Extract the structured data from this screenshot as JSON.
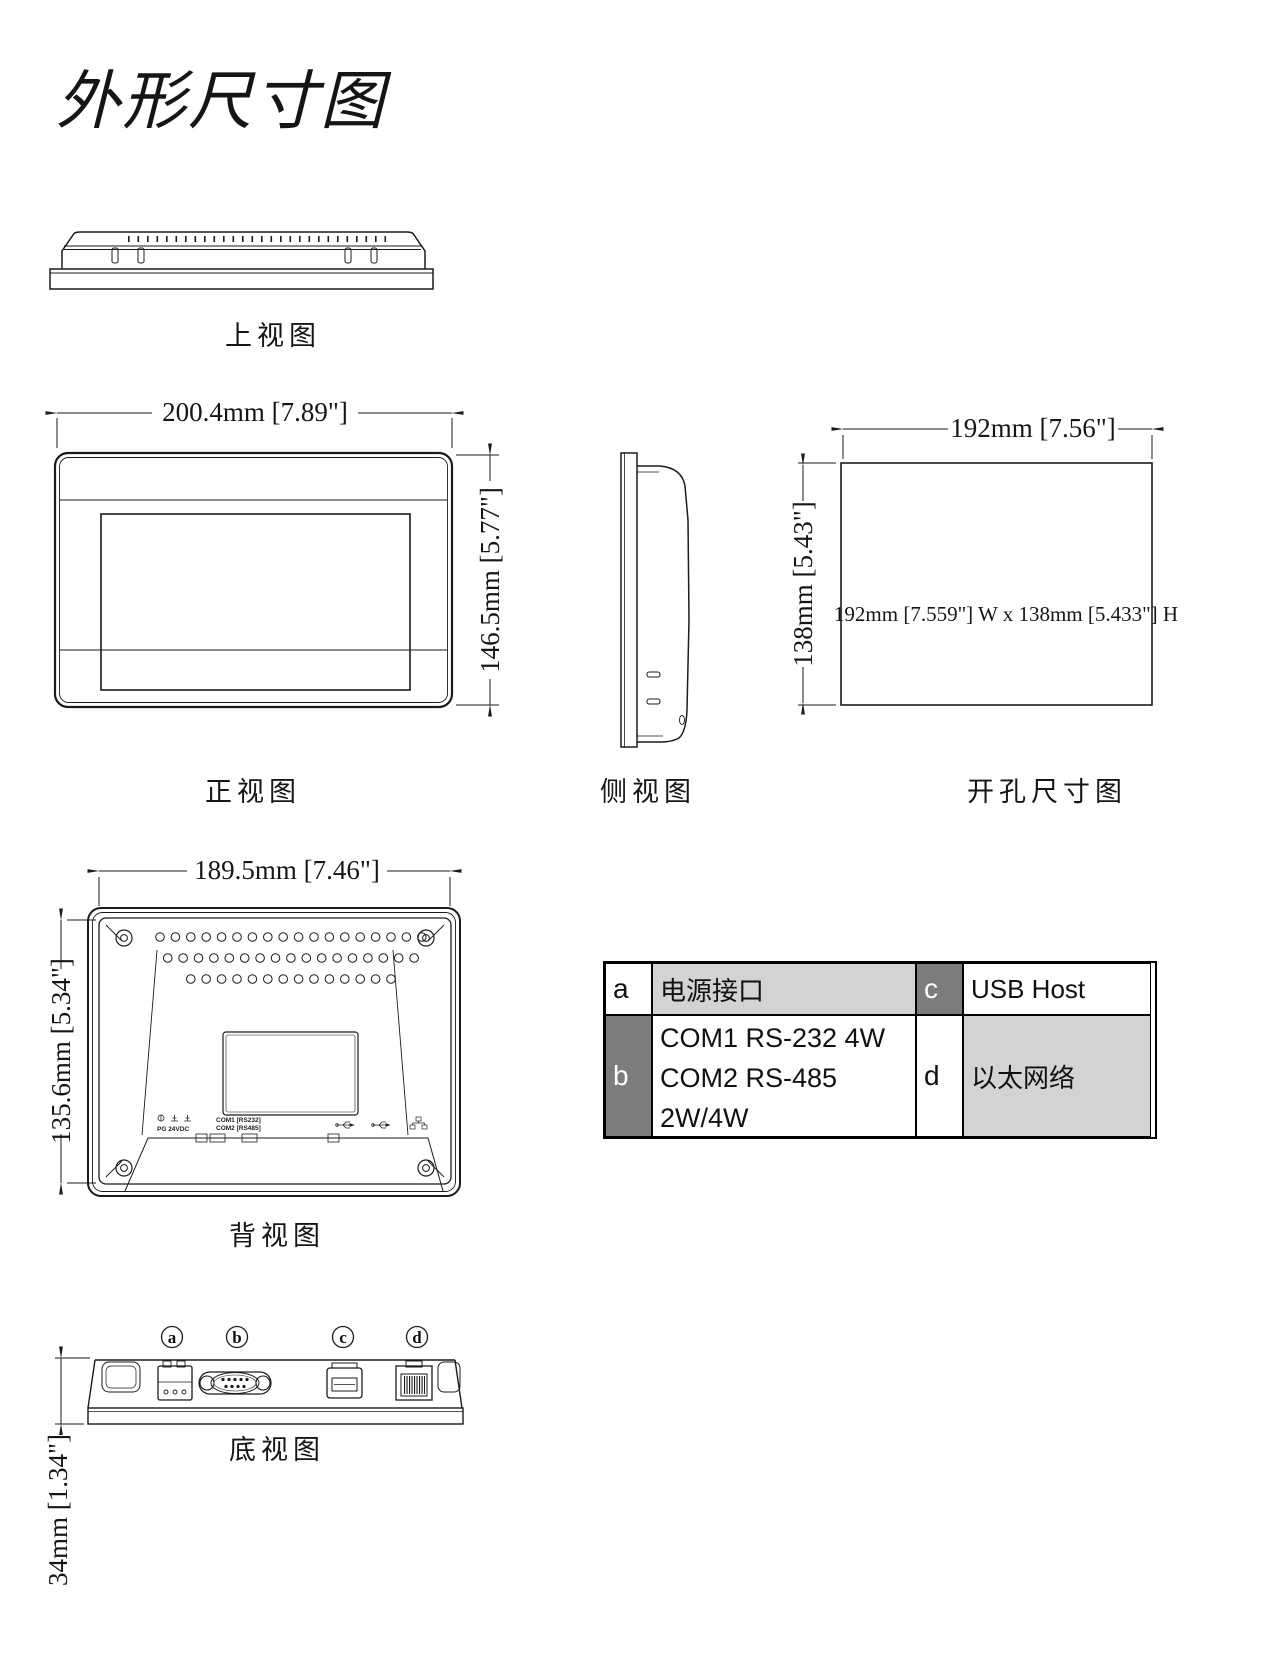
{
  "page": {
    "title": "外形尺寸图",
    "background": "#ffffff",
    "line_color": "#1b1b1b"
  },
  "views": {
    "top": {
      "label": "上视图"
    },
    "front": {
      "label": "正视图",
      "width_dim": "200.4mm [7.89\"]",
      "height_dim": "146.5mm [5.77\"]"
    },
    "side": {
      "label": "侧视图"
    },
    "cutout": {
      "label": "开孔尺寸图",
      "width_dim": "192mm [7.56\"]",
      "height_dim": "138mm [5.43\"]",
      "note": "192mm [7.559\"] W x 138mm [5.433\"] H"
    },
    "back": {
      "label": "背视图",
      "width_dim": "189.5mm [7.46\"]",
      "height_dim": "135.6mm [5.34\"]",
      "markings": {
        "power": "PG  24VDC",
        "com1": "COM1 [RS232]",
        "com2": "COM2 [RS485]"
      }
    },
    "bottom": {
      "label": "底视图",
      "depth_dim": "34mm [1.34\"]",
      "callouts": [
        "a",
        "b",
        "c",
        "d"
      ]
    }
  },
  "legend_table": {
    "a_key": "a",
    "a_value": "电源接口",
    "b_key": "b",
    "b_value_line1": "COM1 RS-232 4W",
    "b_value_line2": "COM2 RS-485",
    "b_value_line3": "2W/4W",
    "c_key": "c",
    "c_value": "USB Host",
    "d_key": "d",
    "d_value": "以太网络",
    "colors": {
      "light_gray": "#d3d3d3",
      "dark_gray": "#7c7c7c",
      "border": "#000000"
    }
  }
}
